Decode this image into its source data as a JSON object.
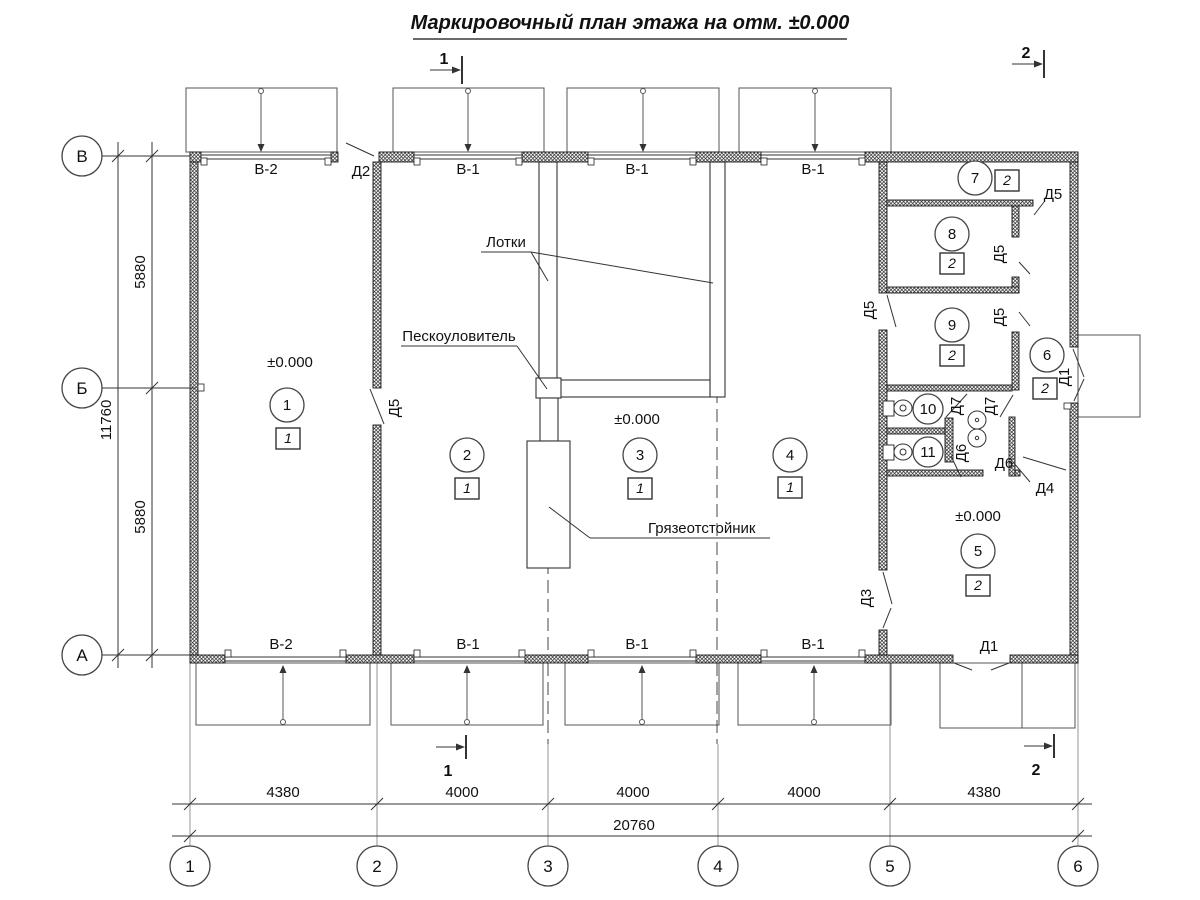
{
  "title": "Маркировочный план этажа на отм. ±0.000",
  "elevation": "±0.000",
  "sections": {
    "s1": "1",
    "s2": "2"
  },
  "grid": {
    "cols": [
      "1",
      "2",
      "3",
      "4",
      "5",
      "6"
    ],
    "rows": [
      "В",
      "Б",
      "А"
    ]
  },
  "dims": {
    "b1": "4380",
    "b2": "4000",
    "b3": "4000",
    "b4": "4000",
    "b5": "4380",
    "btotal": "20760",
    "l1": "5880",
    "l2": "5880",
    "ltotal": "11760"
  },
  "openings": {
    "v1": "В-1",
    "v2": "В-2",
    "d1": "Д1",
    "d2": "Д2",
    "d3": "Д3",
    "d4": "Д4",
    "d5": "Д5",
    "d6": "Д6",
    "d7": "Д7"
  },
  "rooms": {
    "r1": "1",
    "r2": "2",
    "r3": "3",
    "r4": "4",
    "r5": "5",
    "r6": "6",
    "r7": "7",
    "r8": "8",
    "r9": "9",
    "r10": "10",
    "r11": "11"
  },
  "types": {
    "t1": "1",
    "t2": "2"
  },
  "annotations": {
    "trays": "Лотки",
    "sand": "Пескоуловитель",
    "mud": "Грязеотстойник"
  }
}
